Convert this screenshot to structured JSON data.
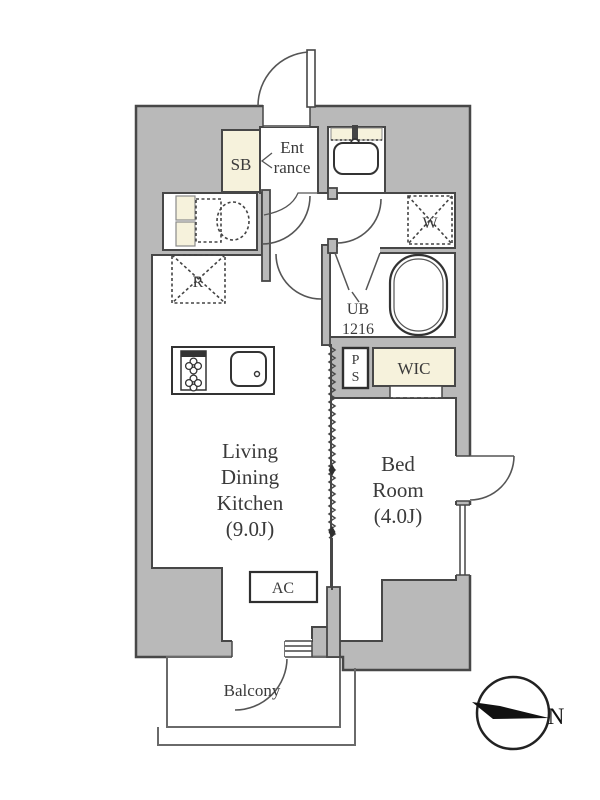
{
  "plan": {
    "rooms": {
      "ldk": {
        "line1": "Living",
        "line2": "Dining",
        "line3": "Kitchen",
        "line4": "(9.0J)",
        "name": "Living Dining Kitchen",
        "size": "9.0J"
      },
      "bedroom": {
        "line1": "Bed",
        "line2": "Room",
        "line3": "(4.0J)",
        "name": "Bed Room",
        "size": "4.0J"
      },
      "entrance": {
        "line1": "Ent",
        "line2": "rance",
        "name": "Entrance"
      },
      "shoe_box": {
        "label": "SB"
      },
      "wic": {
        "label": "WIC"
      },
      "unit_bath": {
        "line1": "UB",
        "line2": "1216"
      },
      "pipe_space": {
        "line1": "P",
        "line2": "S"
      },
      "washer_space": {
        "label": "W"
      },
      "refrigerator_space": {
        "label": "R"
      },
      "air_conditioner": {
        "label": "AC"
      },
      "balcony": {
        "label": "Balcony"
      }
    },
    "compass": {
      "label": "N"
    },
    "colors": {
      "wall_fill": "#b9b9b9",
      "outline": "#474747",
      "cream": "#f6f2dc",
      "text": "#3a3a3a",
      "white": "#ffffff"
    }
  }
}
